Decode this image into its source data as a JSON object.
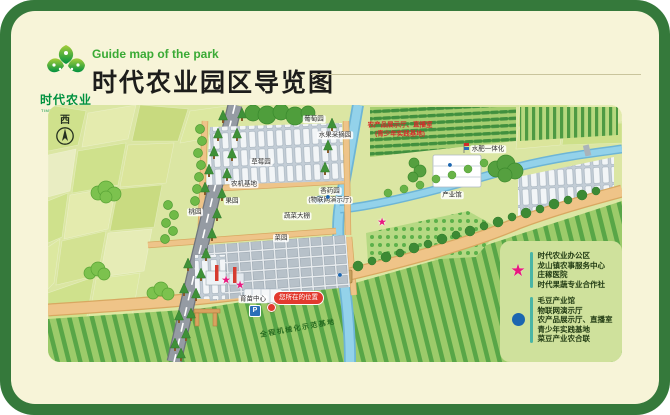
{
  "colors": {
    "frame_green": "#35793b",
    "card_cream": "#f7f4d8",
    "title_green": "#3aaa35",
    "star_pink": "#e8197f",
    "dot_blue": "#1c66b0",
    "badge_red": "#e23a2e"
  },
  "header": {
    "brand": "时代农业",
    "brand_en": "TIMES AGRICULTURE",
    "subtitle": "Guide map of the park",
    "title": "时代农业园区导览图"
  },
  "map": {
    "compass": "西",
    "you_are_here": "您所在的位置",
    "parking": "P",
    "labels": [
      {
        "text": "草莓园",
        "x": 213,
        "y": 57
      },
      {
        "text": "葡萄园",
        "x": 266,
        "y": 14
      },
      {
        "text": "水果采摘园",
        "x": 287,
        "y": 30
      },
      {
        "text": "农机基地",
        "x": 196,
        "y": 79
      },
      {
        "text": "蔬菜大棚",
        "x": 249,
        "y": 111
      },
      {
        "text": "菜园",
        "x": 233,
        "y": 133
      },
      {
        "text": "果园",
        "x": 184,
        "y": 96
      },
      {
        "text": "桃园",
        "x": 147,
        "y": 107
      },
      {
        "text": "育苗中心",
        "x": 205,
        "y": 194
      },
      {
        "text": "香药园",
        "x": 282,
        "y": 86
      },
      {
        "text": "(物联网演示厅)",
        "x": 282,
        "y": 95
      },
      {
        "text": "产业馆",
        "x": 404,
        "y": 90
      },
      {
        "text": "水肥一体化",
        "x": 440,
        "y": 44
      },
      {
        "text": "农产品展示厅、直播室",
        "x": 352,
        "y": 20,
        "cls": "red"
      },
      {
        "text": "(青少年实践基地)",
        "x": 352,
        "y": 29,
        "cls": "red"
      },
      {
        "text": "全程机械化示范基地",
        "x": 250,
        "y": 224,
        "rotate": -10,
        "cls": "road-label"
      }
    ],
    "markers": [
      {
        "type": "star",
        "glyph": "★",
        "x": 178,
        "y": 176
      },
      {
        "type": "star",
        "glyph": "★",
        "x": 192,
        "y": 181
      },
      {
        "type": "star",
        "glyph": "★",
        "x": 334,
        "y": 118
      },
      {
        "type": "dot",
        "glyph": "●",
        "x": 402,
        "y": 60
      },
      {
        "type": "dot",
        "glyph": "●",
        "x": 280,
        "y": 92
      },
      {
        "type": "dot",
        "glyph": "●",
        "x": 292,
        "y": 170
      }
    ]
  },
  "legend": {
    "star_items": [
      "时代农业办公区",
      "龙山镇农事服务中心",
      "庄稼医院",
      "时代果蔬专业合作社"
    ],
    "dot_items": [
      "毛豆产业馆",
      "物联网演示厅",
      "农产品展示厅、直播室",
      "青少年实践基地",
      "菜豆产业农合联"
    ]
  }
}
